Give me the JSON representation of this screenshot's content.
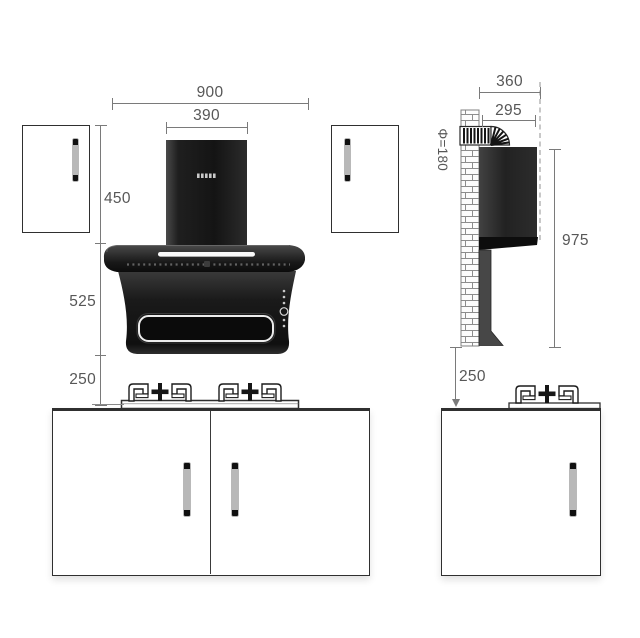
{
  "palette": {
    "dimension_line": "#7a7a7a",
    "dimension_text": "#575757",
    "cabinet_outline": "#2f2f2f",
    "appliance_black": "#141414"
  },
  "dimensions": {
    "front": {
      "overall_width": "900",
      "flue_width": "390",
      "wall_cabinet_height": "450",
      "hood_height": "525",
      "hood_to_countertop": "250"
    },
    "side": {
      "overall_depth": "360",
      "hood_depth": "295",
      "duct_diameter": "Φ=180",
      "install_height": "975",
      "countertop_offset": "250"
    }
  }
}
